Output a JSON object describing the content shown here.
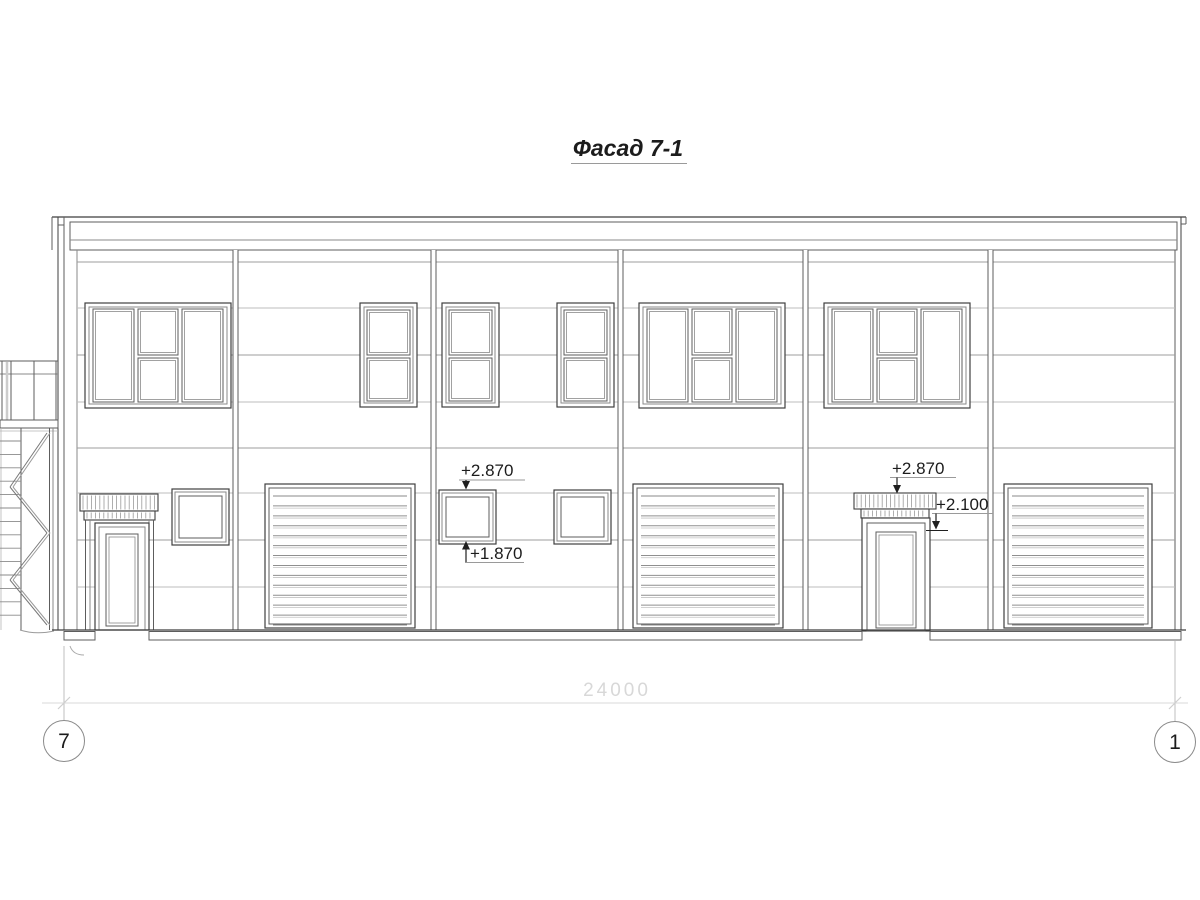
{
  "title": "Фасад 7-1",
  "drawing": {
    "type": "building-facade-elevation",
    "bays": 6,
    "elements": {
      "large_triple_windows": 3,
      "narrow_double_windows": 3,
      "small_square_windows": 3,
      "entry_doors_with_canopy": 2,
      "sectional_gates": 3,
      "external_stair_left": 1
    }
  },
  "annotations": {
    "small_window_head": "+2.870",
    "small_window_sill": "+1.870",
    "canopy_top": "+2.870",
    "door_head": "+2.100"
  },
  "dimension": "24000",
  "axes": {
    "left": "7",
    "right": "1"
  }
}
